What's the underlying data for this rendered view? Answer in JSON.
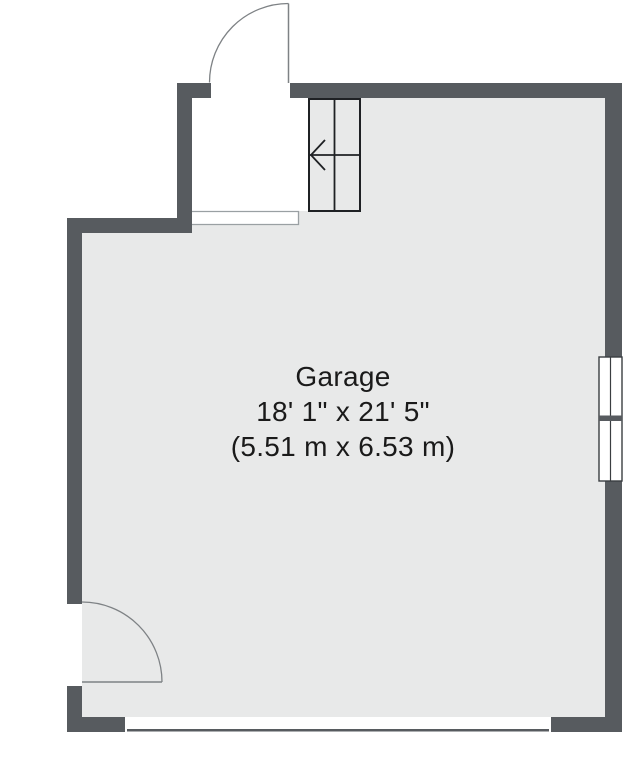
{
  "room": {
    "name": "Garage",
    "dimensions_imperial": "18' 1\" x 21' 5\"",
    "dimensions_metric": "(5.51 m x 6.53 m)"
  },
  "colors": {
    "background": "#ffffff",
    "wall": "#575b5f",
    "floor": "#e8e9e9",
    "stairs_line": "#1f2124",
    "door_swing": "#7e8285",
    "landing_outline": "#9aa0a3",
    "window_frame": "#3a3e41",
    "text": "#1a1a1a"
  }
}
